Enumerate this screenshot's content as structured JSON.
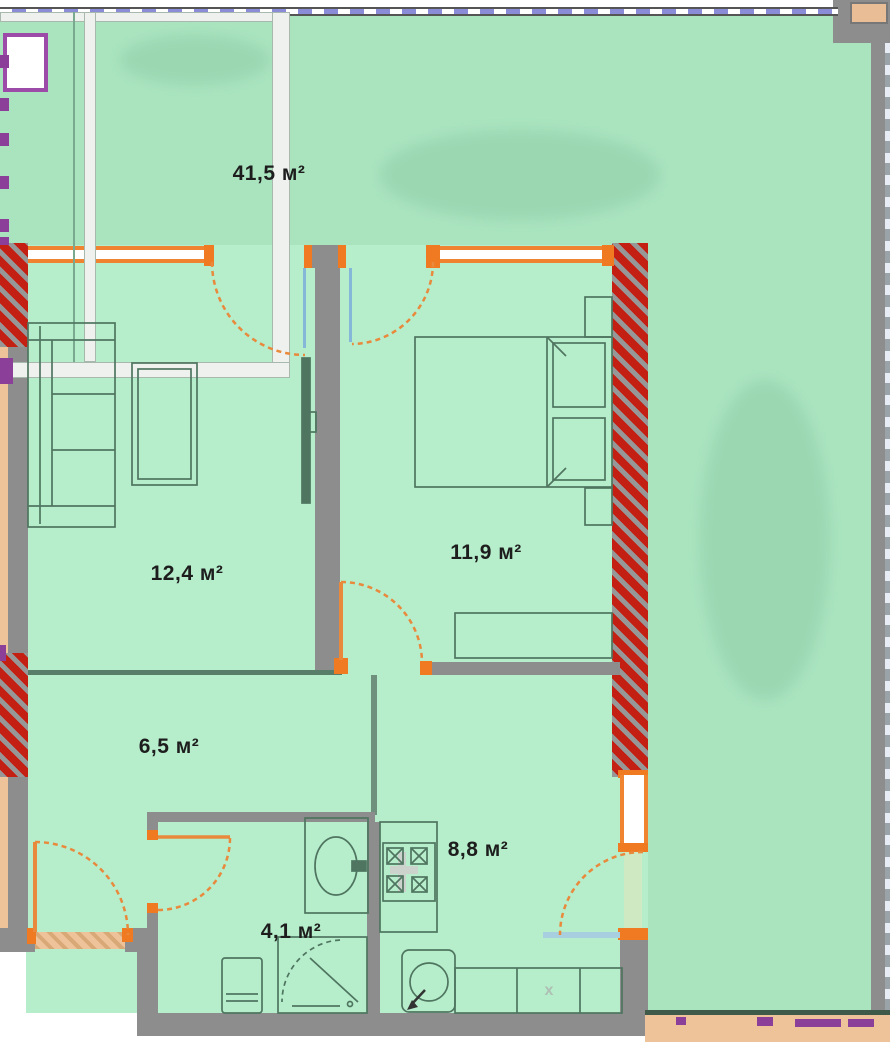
{
  "plan": {
    "type": "apartment-floor-plan",
    "labels": {
      "terrace_area": "41,5 м²",
      "living_area": "12,4 м²",
      "bedroom_area": "11,9 м²",
      "hall_area": "6,5 м²",
      "kitchen_area": "8,8 м²",
      "bath_area": "4,1 м²",
      "counter_mark": "x"
    },
    "rooms": [
      {
        "name": "terrace",
        "area": "41,5 м²"
      },
      {
        "name": "living-room",
        "area": "12,4 м²"
      },
      {
        "name": "bedroom",
        "area": "11,9 м²"
      },
      {
        "name": "hallway",
        "area": "6,5 м²"
      },
      {
        "name": "kitchen",
        "area": "8,8 м²"
      },
      {
        "name": "bathroom",
        "area": "4,1 м²"
      }
    ],
    "colors": {
      "terrace_green": "#a9e4bf",
      "room_green": "#b6edcb",
      "wall_gray": "#8d8d8d",
      "load_bearing_red": "#c32013",
      "window_orange": "#ef8330",
      "furniture_outline": "#4f7560",
      "outside_tan": "#eec39a",
      "boundary_periwinkle": "#8a8cd8",
      "accent_purple": "#8b3f98",
      "accent_blue": "#85b8d8"
    }
  }
}
